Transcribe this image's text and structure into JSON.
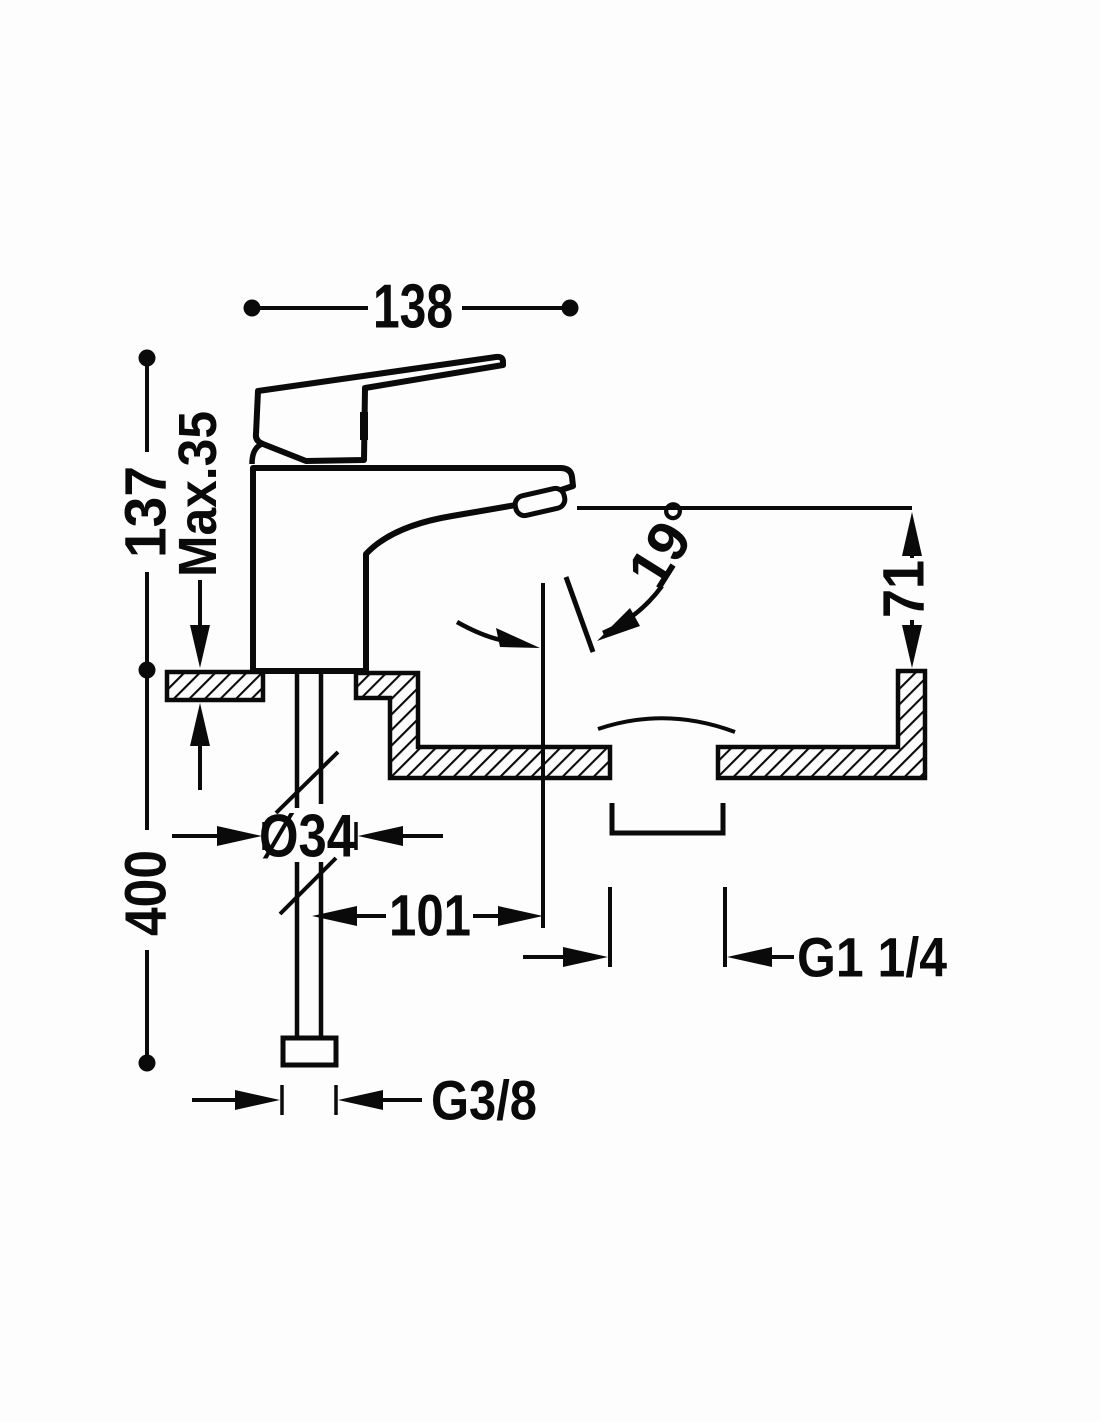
{
  "drawing": {
    "dimensions": {
      "overall_width": "138",
      "body_height": "137",
      "max_deck_thickness": "Max.35",
      "spout_angle": "19°",
      "spout_height": "71",
      "hole_diameter": "Ø34",
      "spout_reach": "101",
      "hose_length": "400",
      "drain_thread": "G1 1/4",
      "supply_thread": "G3/8"
    },
    "colors": {
      "line": "#0a0a0a",
      "background": "#fdfdfd"
    }
  }
}
